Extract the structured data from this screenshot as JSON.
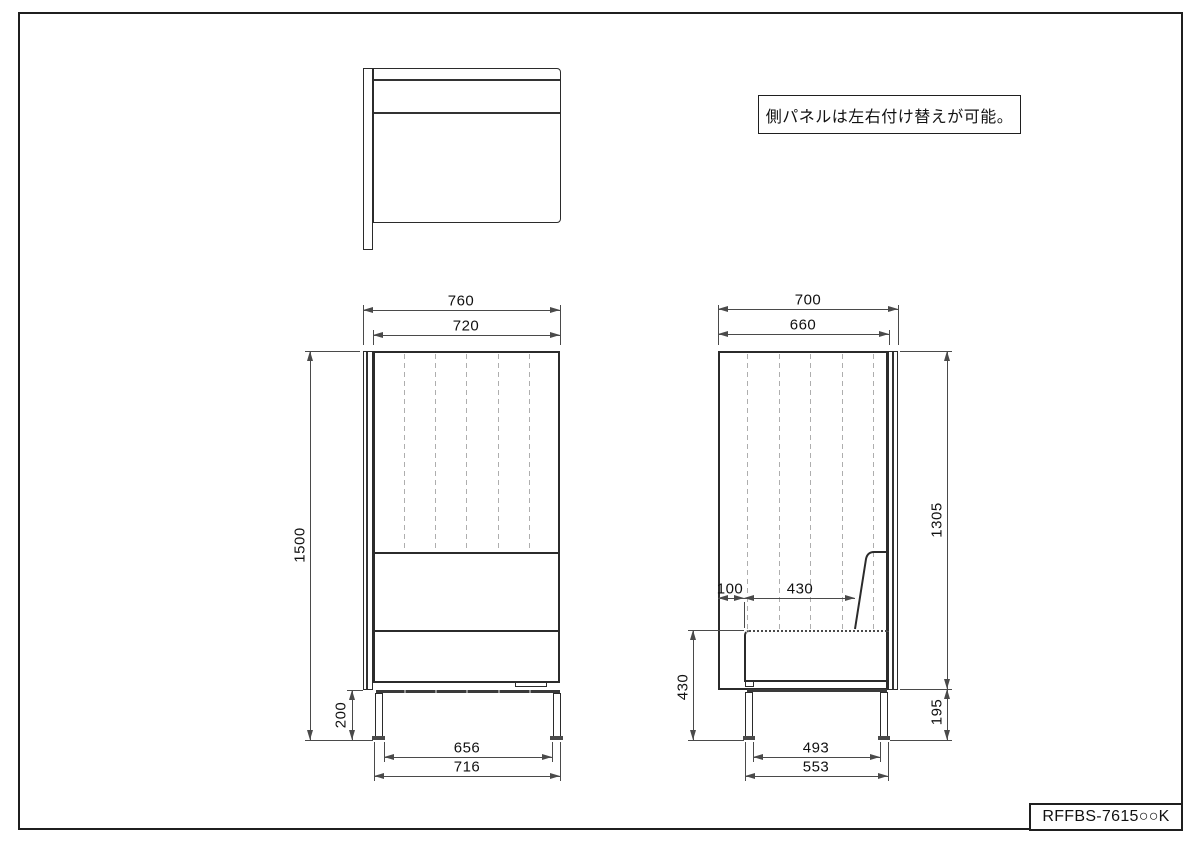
{
  "note": {
    "text": "側パネルは左右付け替えが可能。"
  },
  "title_block": {
    "part_number": "RFFBS-7615○○K"
  },
  "front_view_dims": {
    "overall_width": "760",
    "inner_width": "720",
    "overall_height": "1500",
    "leg_height": "200",
    "leg_inner_span": "656",
    "leg_outer_span": "716"
  },
  "side_view_dims": {
    "overall_depth": "700",
    "inner_depth": "660",
    "panel_height": "1305",
    "back_gap": "100",
    "seat_depth": "430",
    "seat_height": "430",
    "panel_bottom_clearance": "195",
    "leg_inner_span": "493",
    "leg_outer_span": "553"
  }
}
